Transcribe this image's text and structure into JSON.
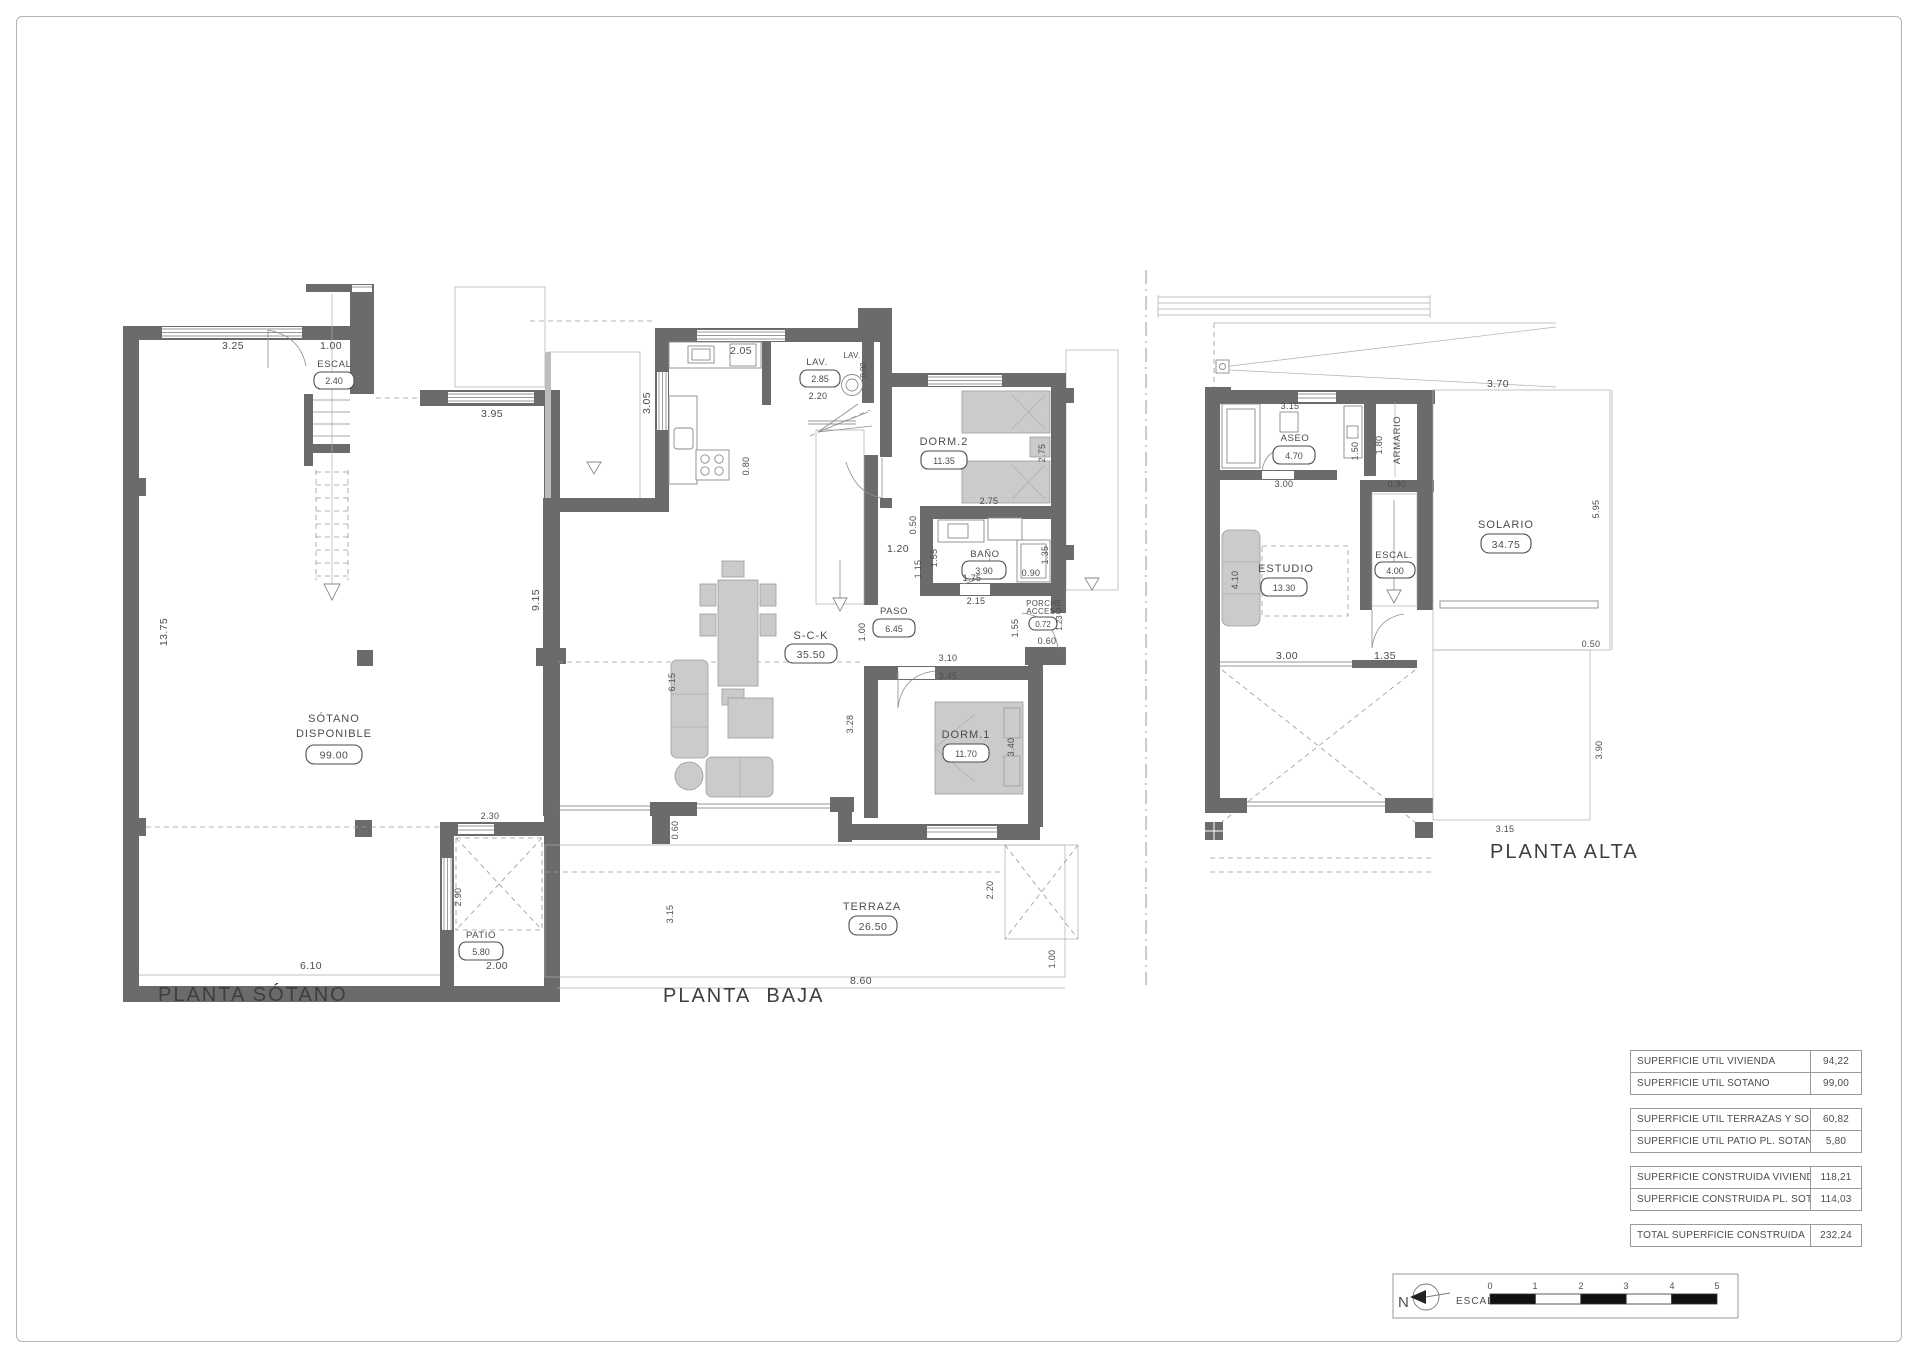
{
  "colors": {
    "wall": "#6b6b6b",
    "furniture": "#cbcbcb",
    "text": "#4c4c4c",
    "deck_line": "#c2c2c2"
  },
  "sotano": {
    "title": "PLANTA SÓTANO",
    "rooms": {
      "escal": "ESCAL.",
      "escal_area": "2.40",
      "main1": "SÓTANO",
      "main2": "DISPONIBLE",
      "main_area": "99.00",
      "patio": "PATIO",
      "patio_area": "5.80"
    },
    "dims": {
      "w325": "3.25",
      "w100": "1.00",
      "w395": "3.95",
      "h1375": "13.75",
      "h915": "9.15",
      "w230": "2.30",
      "h290": "2.90",
      "w610": "6.10",
      "w200": "2.00"
    }
  },
  "baja": {
    "title": "PLANTA  BAJA",
    "rooms": {
      "lav": "LAV.",
      "lav_area": "2.85",
      "lav2": "LAV.",
      "dorm2": "DORM.2",
      "dorm2_area": "11.35",
      "bano": "BAÑO",
      "bano_area": "3.90",
      "paso": "PASO",
      "paso_area": "6.45",
      "sck": "S-C-K",
      "sck_area": "35.50",
      "porche1": "PORCHE",
      "porche2": "ACCESO",
      "porche_area": "0.72",
      "dorm1": "DORM.1",
      "dorm1_area": "11.70",
      "terraza": "TERRAZA",
      "terraza_area": "26.50"
    },
    "dims": {
      "w205": "2.05",
      "h305": "3.05",
      "h080": "0.80",
      "w220": "2.20",
      "h080b": "0.80",
      "h275": "2.75",
      "w275": "2.75",
      "h050": "0.50",
      "h155": "1.55",
      "h115": "1.15",
      "h135": "1.35",
      "w090": "0.90",
      "w175": "1.75",
      "w215": "2.15",
      "w120": "1.20",
      "h100": "1.00",
      "h123": "1.23",
      "w060": "0.60",
      "h155b": "1.55",
      "w310": "3.10",
      "w345": "3.45",
      "h340": "3.40",
      "h328": "3.28",
      "h615": "6.15",
      "h060": "0.60",
      "h315": "3.15",
      "w860": "8.60",
      "h220": "2.20",
      "h100b": "1.00"
    }
  },
  "alta": {
    "title": "PLANTA ALTA",
    "rooms": {
      "aseo": "ASEO",
      "aseo_area": "4.70",
      "armario": "ARMARIO",
      "escal": "ESCAL.",
      "escal_area": "4.00",
      "estudio": "ESTUDIO",
      "estudio_area": "13.30",
      "solario": "SOLARIO",
      "solario_area": "34.75"
    },
    "dims": {
      "w370": "3.70",
      "w315": "3.15",
      "h150": "1.50",
      "h180": "1.80",
      "w090": "0.90",
      "w300": "3.00",
      "h410": "4.10",
      "w300b": "3.00",
      "w135": "1.35",
      "h595": "5.95",
      "w050": "0.50",
      "h390": "3.90",
      "w315b": "3.15"
    }
  },
  "areas_table": {
    "group1": [
      {
        "label": "SUPERFICIE ÚTIL VIVIENDA",
        "value": "94,22"
      },
      {
        "label": "SUPERFICIE ÚTIL SÓTANO",
        "value": "99,00"
      }
    ],
    "group2": [
      {
        "label": "SUPERFICIE ÚTIL TERRAZAS Y SOLARIO",
        "value": "60,82"
      },
      {
        "label": "SUPERFICIE ÚTIL PATIO PL. SÓTANO",
        "value": "5,80"
      }
    ],
    "group3": [
      {
        "label": "SUPERFICIE CONSTRUIDA VIVIENDA",
        "value": "118,21"
      },
      {
        "label": "SUPERFICIE CONSTRUIDA PL. SÓTANO",
        "value": "114,03"
      }
    ],
    "group4": [
      {
        "label": "TOTAL SUPERFICIE CONSTRUIDA",
        "value": "232,24"
      }
    ]
  },
  "scalebar": {
    "north": "N",
    "label": "ESCALA :",
    "ticks": [
      "0",
      "1",
      "2",
      "3",
      "4",
      "5"
    ]
  }
}
